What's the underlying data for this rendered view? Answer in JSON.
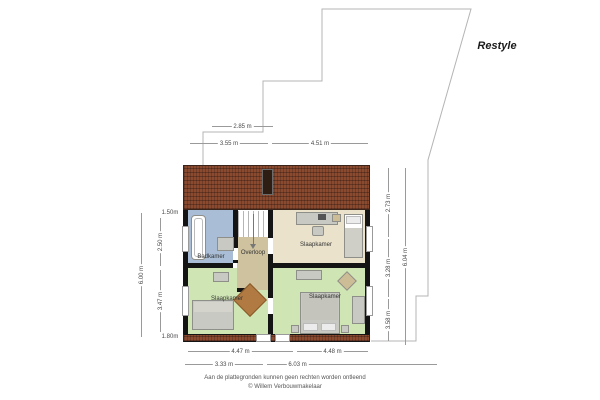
{
  "title_label": "Restyle",
  "rooms": [
    {
      "name": "badkamer",
      "label": "Badkamer"
    },
    {
      "name": "overloop",
      "label": "Overloop"
    },
    {
      "name": "slaapkamer-top",
      "label": "Slaapkamer"
    },
    {
      "name": "slaapkamer-bottom-left",
      "label": "Slaapkamer"
    },
    {
      "name": "slaapkamer-bottom-right",
      "label": "Slaapkamer"
    }
  ],
  "dimensions": {
    "top": [
      "2.85 m",
      "3.55 m",
      "4.51 m"
    ],
    "left_outer": "6.00 m",
    "left_inner": [
      "2.50 m",
      "3.47 m"
    ],
    "left_height_top": "1.50m",
    "left_height_bottom": "1.80m",
    "right_inner": [
      "2.73 m",
      "3.28 m",
      "3.58 m"
    ],
    "right_outer": "6.04 m",
    "bottom_upper": [
      "4.47 m",
      "4.48 m"
    ],
    "bottom_lower": [
      "3.33 m",
      "6.03 m"
    ]
  },
  "footer": {
    "disclaimer": "Aan de plattegronden kunnen geen rechten worden ontleend",
    "copyright": "© Willem Verbouwmakelaar"
  },
  "colors": {
    "roof": "#8a4a30",
    "wall": "#141414",
    "badkamer_floor": "#a9bed6",
    "overloop_floor": "#cec29f",
    "slaapkamer_top_floor": "#eae2cb",
    "slaapkamer_bottom_floor": "#cfe5b4",
    "dimension_line": "#9a9a9a",
    "terrain_outline": "#b4b4b4"
  }
}
